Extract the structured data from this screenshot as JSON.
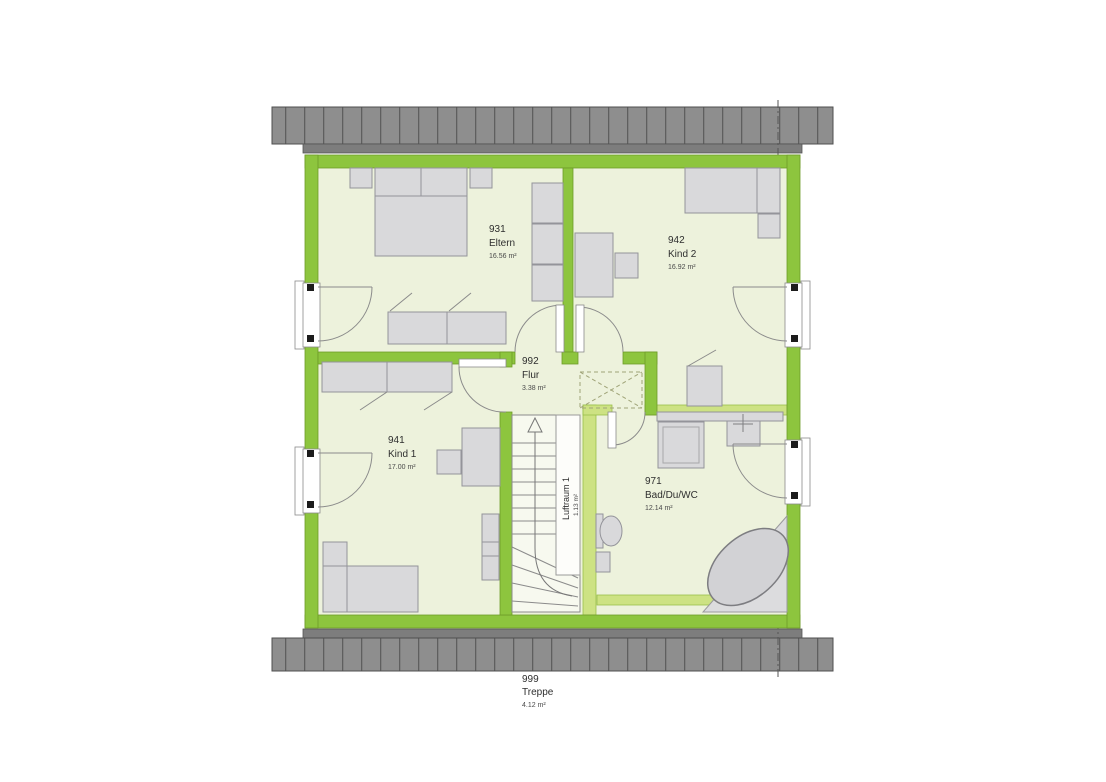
{
  "plan": {
    "type": "floor-plan",
    "rooms": {
      "eltern": {
        "id": "931",
        "name": "Eltern",
        "area": "16.56 m²"
      },
      "kind2": {
        "id": "942",
        "name": "Kind 2",
        "area": "16.92 m²"
      },
      "flur": {
        "id": "992",
        "name": "Flur",
        "area": "3.38 m²"
      },
      "kind1": {
        "id": "941",
        "name": "Kind 1",
        "area": "17.00 m²"
      },
      "bad": {
        "id": "971",
        "name": "Bad/Du/WC",
        "area": "12.14 m²"
      },
      "treppe": {
        "id": "999",
        "name": "Treppe",
        "area": "4.12 m²"
      },
      "luftraum": {
        "name": "Luftraum 1",
        "area": "1.13 m²"
      }
    },
    "colors": {
      "wall_green": "#8dc53e",
      "wall_light_green": "#cde283",
      "floor": "#edf2dc",
      "roof_gray": "#8e8e8e",
      "furniture_gray": "#d9d9db",
      "line_gray": "#8b8b8b"
    }
  }
}
